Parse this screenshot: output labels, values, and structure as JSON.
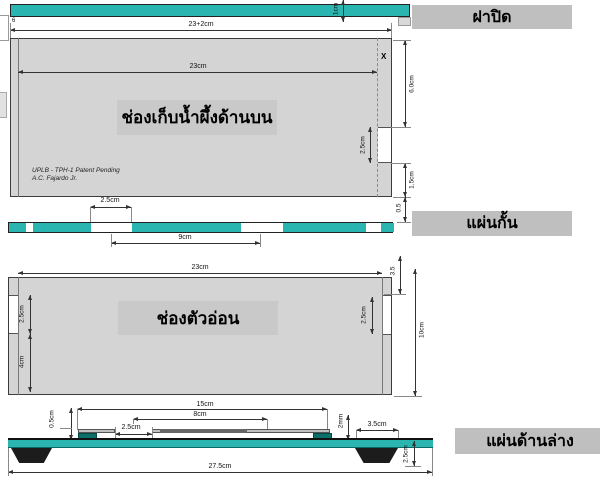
{
  "part_labels": {
    "lid": "ฝาปิด",
    "partition": "แผ่นกั้น",
    "bottom_sheet": "แผ่นด้านล่าง"
  },
  "lid_bar": {
    "thickness": "1cm",
    "edge_mark": "6"
  },
  "honey_chamber": {
    "name": "ช่องเก็บน้ำผึ้งด้านบน",
    "outer_width": "23+2cm",
    "inner_width": "23cm",
    "right_upper": "6.0cm",
    "notch_height": "2.5cm",
    "right_lower": "1.5cm",
    "gap_below": "0.5",
    "x_marker": "X",
    "patent_line1": "UPLB - TPH-1 Patent Pending",
    "patent_line2": "A.C. Fajardo Jr."
  },
  "partition_sheet": {
    "slot_width": "2.5cm",
    "slot_spacing": "9cm"
  },
  "brood_chamber": {
    "name": "ช่องตัวอ่อน",
    "top_width": "23cm",
    "left_notch": "2.5cm",
    "left_lower": "4cm",
    "right_notch": "2.5cm",
    "right_upper": "3.5",
    "height": "10cm"
  },
  "bottom_board": {
    "bars_span": "15cm",
    "inner_span": "8cm",
    "entrance_width": "2.5cm",
    "bar_height": "0.5cm",
    "strip_thickness": "2mm",
    "leg_top_width": "3.5cm",
    "leg_height": "2.5cm",
    "total_width": "27.5cm"
  },
  "colors": {
    "teal": "#2ab5b0",
    "dark_teal": "#0c6e68",
    "panel_gray": "#d4d4d4",
    "overlay_gray": "#c9c9c9",
    "label_box_gray": "#bfbfbf",
    "line": "#333333"
  }
}
